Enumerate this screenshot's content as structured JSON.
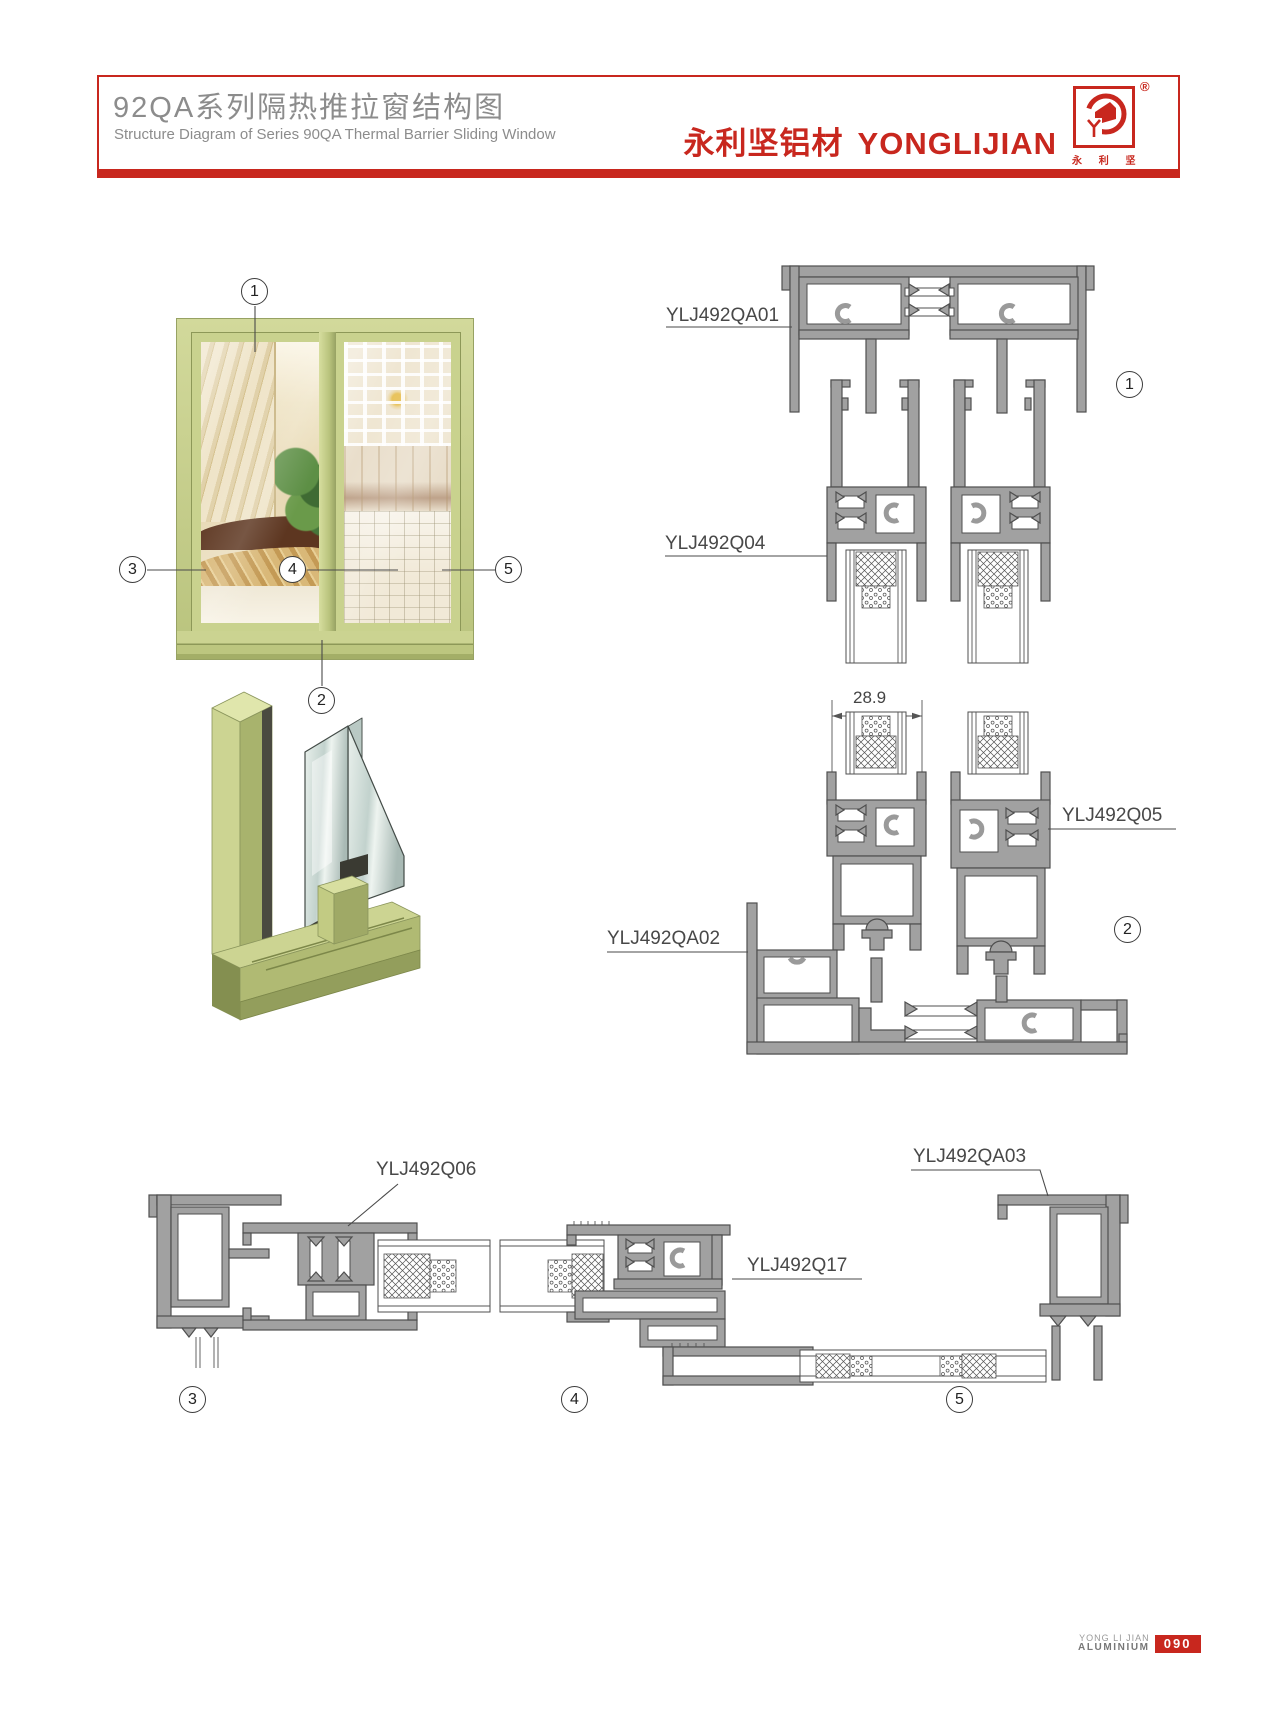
{
  "header": {
    "title_cn": "92QA系列隔热推拉窗结构图",
    "title_en": "Structure Diagram of Series 90QA Thermal Barrier Sliding Window",
    "brand_cn": "永利坚铝材",
    "brand_en": "YONGLIJIAN",
    "registered": "®",
    "logo_caption": "永 利 坚"
  },
  "figure": {
    "dimension": "28.9",
    "callouts": {
      "c1": "1",
      "c2": "2",
      "c3": "3",
      "c4": "4",
      "c5": "5"
    },
    "profile_labels": {
      "qa01": "YLJ492QA01",
      "q04": "YLJ492Q04",
      "q05": "YLJ492Q05",
      "qa02": "YLJ492QA02",
      "q06": "YLJ492Q06",
      "q17": "YLJ492Q17",
      "qa03": "YLJ492QA03"
    }
  },
  "footer": {
    "company_line1": "YONG LI JIAN",
    "company_line2": "ALUMINIUM",
    "page": "090"
  },
  "colors": {
    "accent": "#c8271e",
    "profile_gray": "#a1a1a1",
    "frame_green": "#c9d28e"
  }
}
